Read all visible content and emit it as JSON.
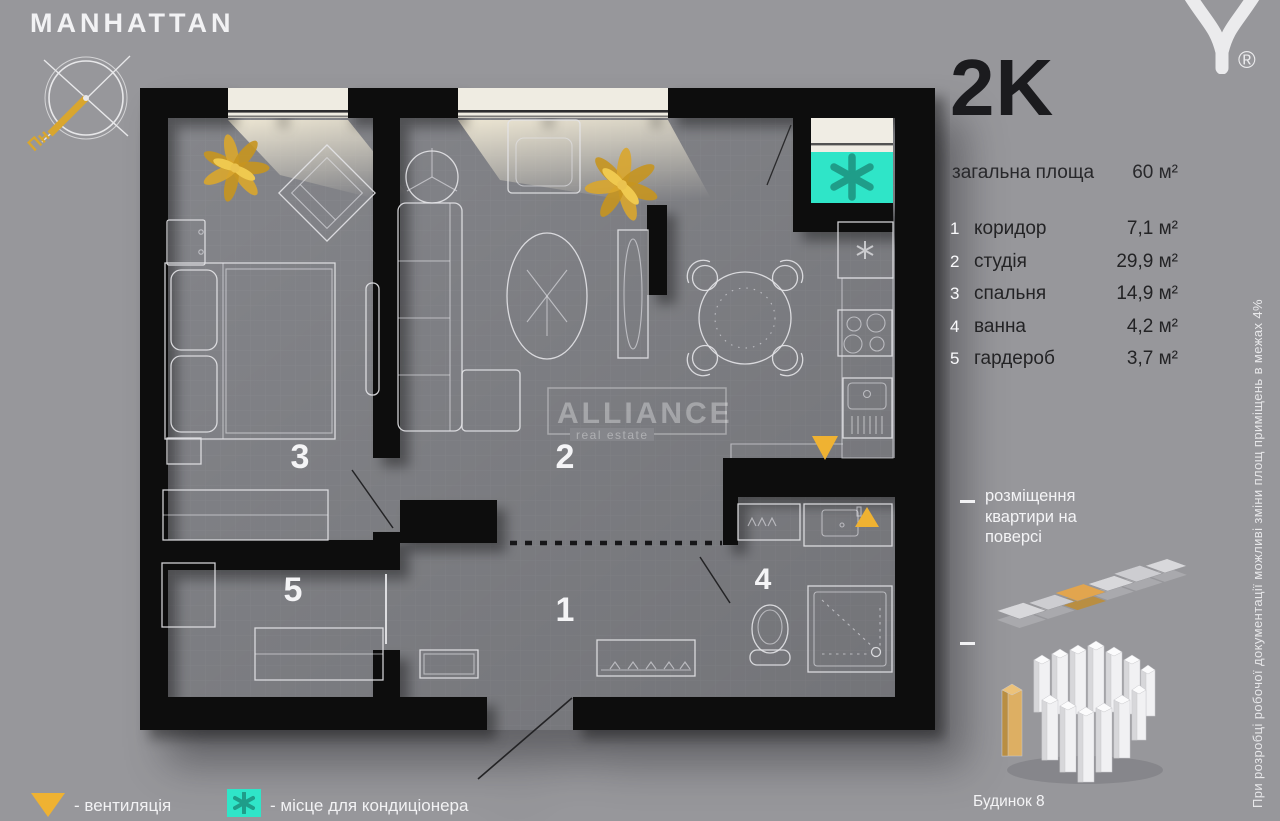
{
  "project": {
    "title": "MANHATTAN",
    "compass_label": "Пн"
  },
  "brand": {
    "watermark": "ALLIANCE",
    "watermark_sub": "real estate",
    "registered": "®"
  },
  "summary": {
    "type": "2K",
    "total_area_label": "загальна площа",
    "total_area_value": "60 м²"
  },
  "rooms": [
    {
      "num": "1",
      "name": "коридор",
      "area": "7,1 м²"
    },
    {
      "num": "2",
      "name": "студія",
      "area": "29,9 м²"
    },
    {
      "num": "3",
      "name": "спальня",
      "area": "14,9 м²"
    },
    {
      "num": "4",
      "name": "ванна",
      "area": "4,2 м²"
    },
    {
      "num": "5",
      "name": "гардероб",
      "area": "3,7 м²"
    }
  ],
  "location": {
    "floor_caption": "розміщення квартири на поверсі",
    "building_caption": "Будинок 8"
  },
  "legend": [
    {
      "symbol": "gold-triangle",
      "label": "- вентиляція"
    },
    {
      "symbol": "teal-asterisk",
      "label": "- місце для кондиціонера"
    }
  ],
  "disclaimer": "При розробці робочої документації можливі зміни площ приміщень в межах 4%",
  "colors": {
    "bg": "#97979B",
    "floor": "#85868B",
    "wall": "#0C0C0E",
    "accent_gold": "#EFB232",
    "accent_teal": "#2FE5C8",
    "text_dark": "#232325",
    "text_light": "#F4F4F6",
    "unit_highlight_orange": "#E2A54E",
    "building_highlight_gold": "#DDAF63"
  }
}
